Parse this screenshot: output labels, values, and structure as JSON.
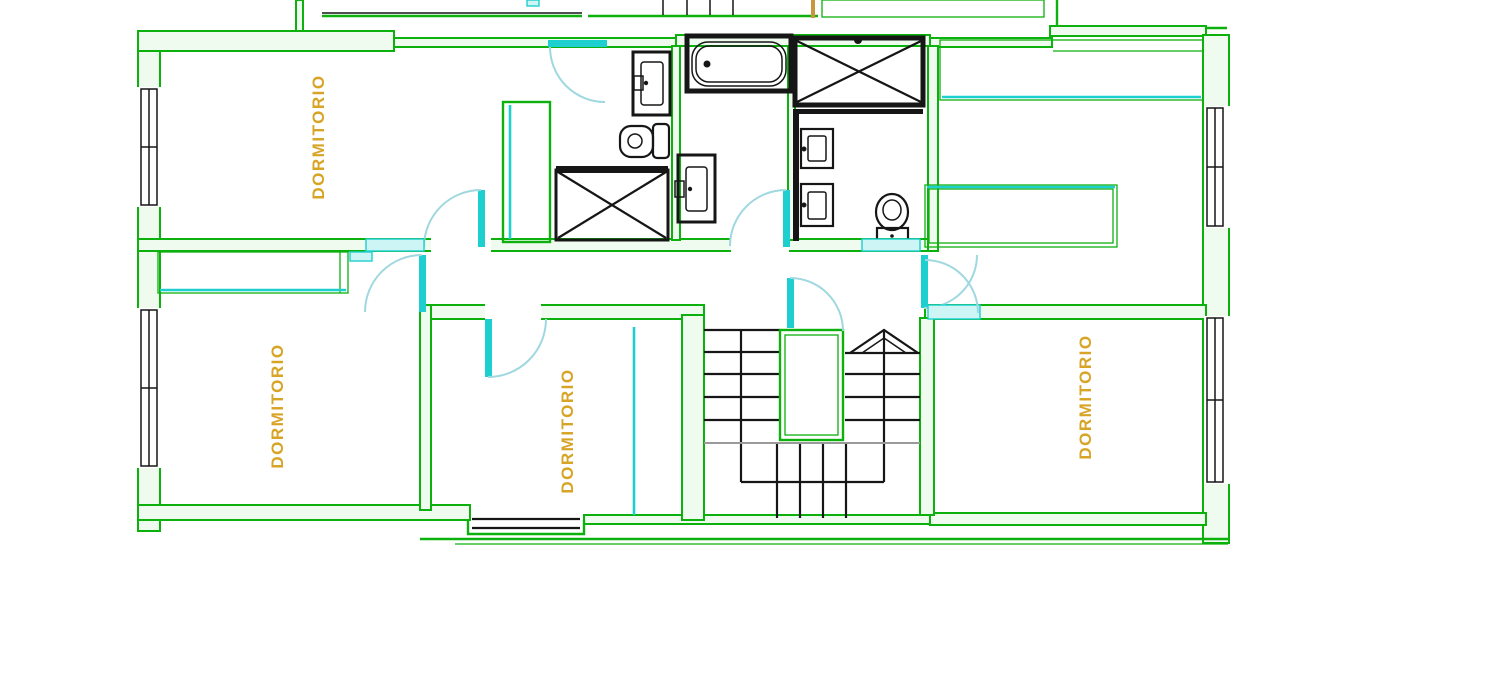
{
  "drawing": {
    "type": "architectural-floor-plan",
    "floor_use": "bedroom level with two bathrooms and U-stair"
  },
  "room_labels": {
    "top_left": "DORMITORIO",
    "bottom_left": "DORMITORIO",
    "bottom_center": "DORMITORIO",
    "bottom_right": "DORMITORIO"
  },
  "colors": {
    "wall-green": "#0db10d",
    "wall-fill": "#eefbee",
    "cyan": "#1ecfcf",
    "cyan-fill": "#cdf5f5",
    "arc": "#9fd8df",
    "black": "#161616",
    "gray": "#9a9a9a",
    "label-orange": "#d8a425",
    "wood": "#c8963c",
    "background": "#ffffff"
  },
  "fixture_icons": [
    "bathtub-icon",
    "shower-x-icon",
    "shower-x-bold-icon",
    "sink-icon",
    "toilet-icon",
    "stairs-icon",
    "stair-direction-arrow-icon",
    "window-icon",
    "door-arc-icon",
    "wardrobe-icon",
    "desk-icon",
    "closet-icon"
  ]
}
